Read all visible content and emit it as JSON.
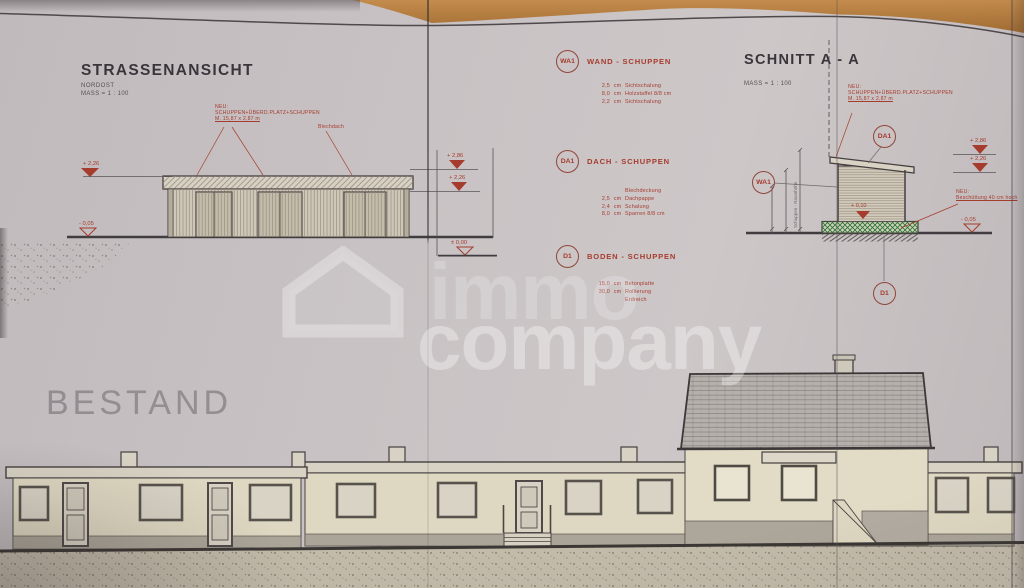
{
  "views": {
    "street": {
      "title": "STRASSENANSICHT",
      "subtitle": "NORDOST",
      "scale": "MASS = 1 : 100"
    },
    "section": {
      "title": "SCHNITT A - A",
      "scale": "MASS = 1 : 100"
    }
  },
  "legend": {
    "wa1": {
      "code": "WA1",
      "title": "WAND - SCHUPPEN",
      "rows": [
        {
          "value": "2,5",
          "unit": "cm",
          "text": "Sichtschalung"
        },
        {
          "value": "8,0",
          "unit": "cm",
          "text": "Holzstaffel 8/8 cm"
        },
        {
          "value": "2,2",
          "unit": "cm",
          "text": "Sichtschalung"
        }
      ]
    },
    "da1": {
      "code": "DA1",
      "title": "DACH - SCHUPPEN",
      "rows": [
        {
          "value": "",
          "unit": "",
          "text": "Blechdeckung"
        },
        {
          "value": "2,5",
          "unit": "cm",
          "text": "Dachpappe"
        },
        {
          "value": "2,4",
          "unit": "cm",
          "text": "Schalung"
        },
        {
          "value": "8,0",
          "unit": "cm",
          "text": "Sparren 8/8 cm"
        }
      ]
    },
    "d1": {
      "code": "D1",
      "title": "BODEN - SCHUPPEN",
      "rows": [
        {
          "value": "15,0",
          "unit": "cm",
          "text": "Betonplatte"
        },
        {
          "value": "30,0",
          "unit": "cm",
          "text": "Rollierung"
        },
        {
          "value": "",
          "unit": "",
          "text": "Erdreich"
        }
      ]
    }
  },
  "annotations": {
    "neu_shed": {
      "l1": "NEU:",
      "l2": "SCHUPPEN+ÜBERD.PLATZ+SCHUPPEN",
      "l3": "M. 15,87 x 2,87 m"
    },
    "blechdach": "Blechdach",
    "neu_floor": {
      "l1": "NEU:",
      "l2": "Beschüttung 40 cm hoch"
    },
    "raumhoehe": "Schuppen - Raumhöhe",
    "bestand": "BESTAND"
  },
  "levels": {
    "p286": "+ 2,86",
    "p226": "+ 2,26",
    "zero": "± 0,00",
    "m005": "- 0,05",
    "p010": "+ 0,10"
  },
  "watermark": {
    "word1": "immo",
    "word2": "company"
  },
  "colors": {
    "annotation_red": "#a63c2e",
    "ink": "#45403f",
    "paper": "#c8c2c4",
    "wood": "#b9813f",
    "slab_green": "#2f6d35",
    "watermark_white": "#ffffff"
  }
}
